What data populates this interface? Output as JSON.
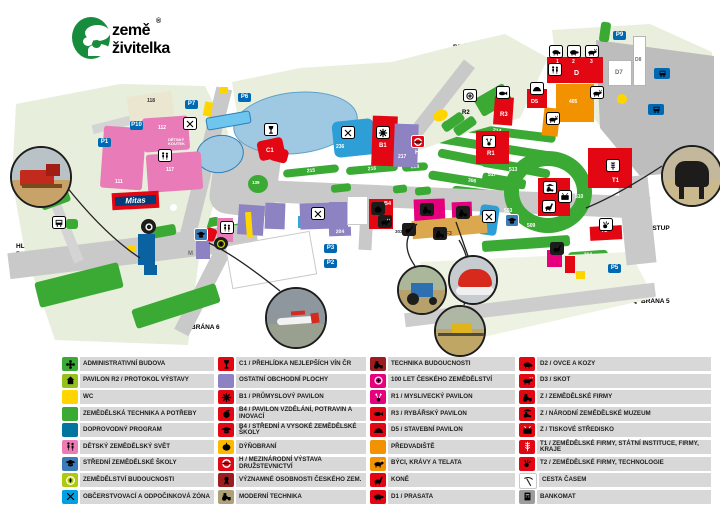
{
  "logo": {
    "word1": "země",
    "word2": "živitelka",
    "reg": "®"
  },
  "map": {
    "gates": {
      "b1a": "HLAVNÍ",
      "b1b": "BRÁNA 1",
      "b2": "BRÁNA 2",
      "b3": "BRÁNA 3",
      "b4": "BRÁNA 4",
      "b5": "BRÁNA 5",
      "b6": "BRÁNA 6",
      "vstup": "VSTUP",
      "mhd1": "ZASTÁVKA MHD",
      "mhd2": "VÝSTAVIŠTĚ"
    },
    "parking": {
      "p1": "P1",
      "p2": "P2",
      "p3": "P3",
      "p5": "P5",
      "p6": "P6",
      "p7": "P7",
      "p9": "P9",
      "p10": "P10"
    },
    "brands": {
      "mitas": "Mitas"
    },
    "pavilions": {
      "c1": "C1",
      "b1": "B1",
      "b4": "B4",
      "h": "H",
      "r1": "R1",
      "r2": "R2",
      "r3": "R3",
      "d": "D",
      "d5": "D5",
      "d7": "D7",
      "d8": "D8",
      "t1": "T1",
      "t2": "T2",
      "m": "M",
      "s": "S",
      "f3": "F3",
      "detsky": "DĚTSKÝ KOUTEK",
      "d_1": "1",
      "d_2": "2",
      "d_3": "3"
    },
    "areas": {
      "n104": "104",
      "n105": "105",
      "n106": "106",
      "n108": "108",
      "n111": "111",
      "n112": "112",
      "n113": "113",
      "n114": "114",
      "n115": "115",
      "n116": "116",
      "n117": "117",
      "n118": "118",
      "n139": "139",
      "n204": "204",
      "n214": "214",
      "n215": "215",
      "n216": "216",
      "n217": "217",
      "n218": "218",
      "n230": "230",
      "n236": "236",
      "n303": "303",
      "n306": "306",
      "n308": "308",
      "n317": "317",
      "n405": "405",
      "n406": "406",
      "n503": "503",
      "n509": "509",
      "n510": "510",
      "n513": "513",
      "n517": "517",
      "n704": "704",
      "n708": "708"
    }
  },
  "colors": {
    "red": "#e30613",
    "darkred": "#9d1c20",
    "magenta": "#e6007e",
    "orange": "#f39200",
    "amber": "#fbba00",
    "yellow": "#ffd500",
    "green": "#3aaa35",
    "lightgreen": "#95c11f",
    "petrol": "#00769e",
    "blue": "#3b7cb8",
    "cyan": "#00a0e3",
    "pink": "#ef7bb5",
    "lavender": "#8d83c2",
    "yellowgreen": "#afca0b",
    "khaki": "#b0a077",
    "white": "#ffffff",
    "gray": "#9d9d9c",
    "parking": "#0069b4"
  },
  "legend": {
    "columns": [
      [
        {
          "label": "ADMINISTRATIVNÍ BUDOVA",
          "icon": "flower",
          "color": "green"
        },
        {
          "label": "PAVILON R2 / PROTOKOL VÝSTAVY",
          "icon": "building",
          "color": "lightgreen"
        },
        {
          "label": "WC",
          "icon": "",
          "color": "yellow"
        },
        {
          "label": "ZEMĚDĚLSKÁ TECHNIKA A POTŘEBY",
          "icon": "",
          "color": "green"
        },
        {
          "label": "DOPROVODNÝ PROGRAM",
          "icon": "",
          "color": "petrol"
        },
        {
          "label": "DĚTSKÝ ZEMĚDĚLSKÝ SVĚT",
          "icon": "kids",
          "color": "pink"
        },
        {
          "label": "STŘEDNÍ ZEMĚDĚLSKÉ ŠKOLY",
          "icon": "gradcap",
          "color": "blue"
        },
        {
          "label": "ZEMĚDĚLSTVÍ BUDOUCNOSTI",
          "icon": "leafcircle",
          "color": "yellowgreen"
        },
        {
          "label": "OBČERSTVOVACÍ A ODPOČINKOVÁ ZÓNA",
          "icon": "cutlery",
          "color": "cyan"
        }
      ],
      [
        {
          "label": "C1 / PŘEHLÍDKA NEJLEPŠÍCH VÍN ČR",
          "icon": "wine",
          "color": "red"
        },
        {
          "label": "OSTATNÍ OBCHODNÍ PLOCHY",
          "icon": "",
          "color": "lavender"
        },
        {
          "label": "B1 / PRŮMYSLOVÝ PAVILON",
          "icon": "gear",
          "color": "red"
        },
        {
          "label": "B4 / PAVILON VZDĚLÁNÍ, POTRAVIN A INOVACÍ",
          "icon": "apple",
          "color": "red"
        },
        {
          "label": "B4 / STŘEDNÍ A VYSOKÉ ZEMĚDĚLSKÉ ŠKOLY",
          "icon": "gradcap",
          "color": "red"
        },
        {
          "label": "DÝŇOBRANÍ",
          "icon": "pumpkin",
          "color": "amber"
        },
        {
          "label": "H / MEZINÁRODNÍ VÝSTAVA DRUŽSTEVNICTVÍ",
          "icon": "roundel",
          "color": "red"
        },
        {
          "label": "VÝZNAMNÉ OSOBNOSTI ČESKÉHO ZEM.",
          "icon": "medal",
          "color": "darkred"
        },
        {
          "label": "MODERNÍ TECHNIKA",
          "icon": "tractor",
          "color": "khaki"
        }
      ],
      [
        {
          "label": "TECHNIKA BUDOUCNOSTI",
          "icon": "tractor",
          "color": "darkred"
        },
        {
          "label": "100 LET ČESKÉHO ZEMĚDĚLSTVÍ",
          "icon": "t100",
          "color": "magenta"
        },
        {
          "label": "R1 / MYSLIVECKÝ PAVILON",
          "icon": "deer",
          "color": "magenta"
        },
        {
          "label": "R3 / RYBÁŘSKÝ PAVILON",
          "icon": "fish",
          "color": "red"
        },
        {
          "label": "D5 / STAVEBNÍ PAVILON",
          "icon": "hardhat",
          "color": "red"
        },
        {
          "label": "PŘEDVADIŠTĚ",
          "icon": "",
          "color": "orange"
        },
        {
          "label": "BÝCI, KRÁVY A TELATA",
          "icon": "cow",
          "color": "orange"
        },
        {
          "label": "KONĚ",
          "icon": "horse",
          "color": "red"
        },
        {
          "label": "D1 / PRASATA",
          "icon": "pig",
          "color": "red"
        }
      ],
      [
        {
          "label": "D2 / OVCE A KOZY",
          "icon": "sheep",
          "color": "red"
        },
        {
          "label": "D3 / SKOT",
          "icon": "cow",
          "color": "red"
        },
        {
          "label": "Z / ZEMĚDĚLSKÉ FIRMY",
          "icon": "tractor",
          "color": "red"
        },
        {
          "label": "Z / NÁRODNÍ ZEMĚDĚLSKÉ MUZEUM",
          "icon": "museum",
          "color": "red"
        },
        {
          "label": "Z / TISKOVÉ STŘEDISKO",
          "icon": "tv",
          "color": "red"
        },
        {
          "label": "T1 / ZEMĚDĚLSKÉ FIRMY, STÁTNÍ INSTITUCE, FIRMY, KRAJE",
          "icon": "wheat",
          "color": "red"
        },
        {
          "label": "T2 / ZEMĚDĚLSKÉ FIRMY, TECHNOLOGIE",
          "icon": "hand",
          "color": "red"
        },
        {
          "label": "CESTA ČASEM",
          "icon": "scythe",
          "color": "white",
          "ink": "dark"
        },
        {
          "label": "BANKOMAT",
          "icon": "atm",
          "color": "gray",
          "ink": "dark"
        }
      ]
    ]
  }
}
